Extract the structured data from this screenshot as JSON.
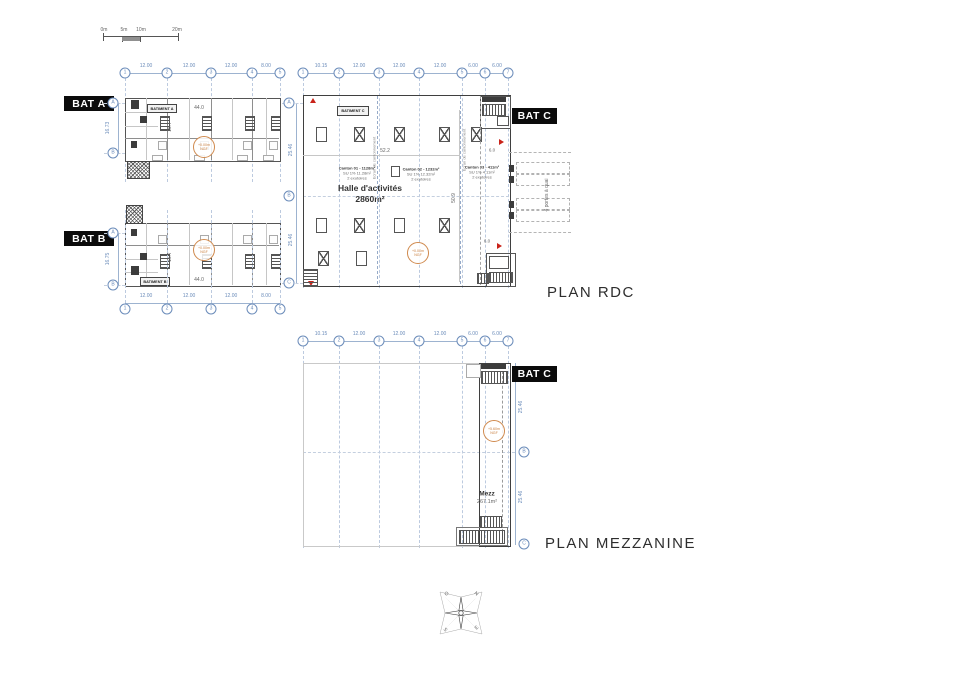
{
  "scale_bar": {
    "labels": [
      "0m",
      "5m",
      "10m",
      "20m"
    ]
  },
  "plans": {
    "rdc_title": "PLAN RDC",
    "mezz_title": "PLAN MEZZANINE"
  },
  "bat_a": {
    "tag": "BAT A",
    "name_box": "BATIMENT A",
    "bubbles_top": [
      "1",
      "2",
      "3",
      "4",
      "5"
    ],
    "dims_top": [
      "12.00",
      "12.00",
      "12.00",
      "8.00"
    ],
    "bubbles_left": [
      "A",
      "B"
    ],
    "dim_left": "16.73",
    "dim_width": "44.0",
    "dim_height": "16.7",
    "level": {
      "l1": "+0.00m",
      "l2": "NGF"
    }
  },
  "bat_b": {
    "tag": "BAT B",
    "name_box": "BATIMENT B",
    "bubbles_bottom": [
      "1",
      "2",
      "3",
      "4",
      "5"
    ],
    "dims_bottom": [
      "12.00",
      "12.00",
      "12.00",
      "8.00"
    ],
    "bubbles_left": [
      "A",
      "B"
    ],
    "dim_left": "16.75",
    "dim_width": "44.0",
    "dim_height": "16.7",
    "level": {
      "l1": "+0.00m",
      "l2": "NGF"
    }
  },
  "rdc": {
    "tag": "BAT C",
    "name_box": "BATIMENT C",
    "bubbles_top": [
      "1",
      "2",
      "3",
      "4",
      "5",
      "6",
      "7"
    ],
    "dims_top": [
      "10.15",
      "12.00",
      "12.00",
      "12.00",
      "6.00",
      "6.00"
    ],
    "bubbles_left": [
      "A",
      "B",
      "C"
    ],
    "dims_left": [
      "25.46",
      "25.46"
    ],
    "hall_name": "Halle d'activités",
    "hall_area": "2860m²",
    "dim_width": "52.2",
    "dim_height": "50.9",
    "dim_dock": "6.0",
    "dim_dock2": "6.0",
    "cantons": [
      {
        "l1": "Canton 01 - 1128m²",
        "l2": "SU 1% 11.28m²",
        "l3": "2 exutoires"
      },
      {
        "l1": "Canton 02 - 1232m²",
        "l2": "SU 1% 12.32m²",
        "l3": "2 exutoires"
      },
      {
        "l1": "Canton 03 - 411m²",
        "l2": "SU 1% 4.11m²",
        "l3": "2 exutoires"
      }
    ],
    "curtain": "Ecran de cantonnement",
    "dock_label": "4 portes à quai",
    "level": {
      "l1": "+0.00m",
      "l2": "NGF"
    }
  },
  "mezz": {
    "tag": "BAT C",
    "bubbles_top": [
      "1",
      "2",
      "3",
      "4",
      "5",
      "6",
      "7"
    ],
    "dims_top": [
      "10.15",
      "12.00",
      "12.00",
      "12.00",
      "6.00",
      "6.00"
    ],
    "bubbles_right": [
      "B",
      "C"
    ],
    "dims_right": [
      "25.46",
      "25.46"
    ],
    "room": "Mezz",
    "room_area": "267.1m²",
    "level": {
      "l1": "+5.60m",
      "l2": "NGF"
    }
  },
  "compass": {
    "n": "N",
    "o": "O",
    "s": "S",
    "e": "E"
  }
}
